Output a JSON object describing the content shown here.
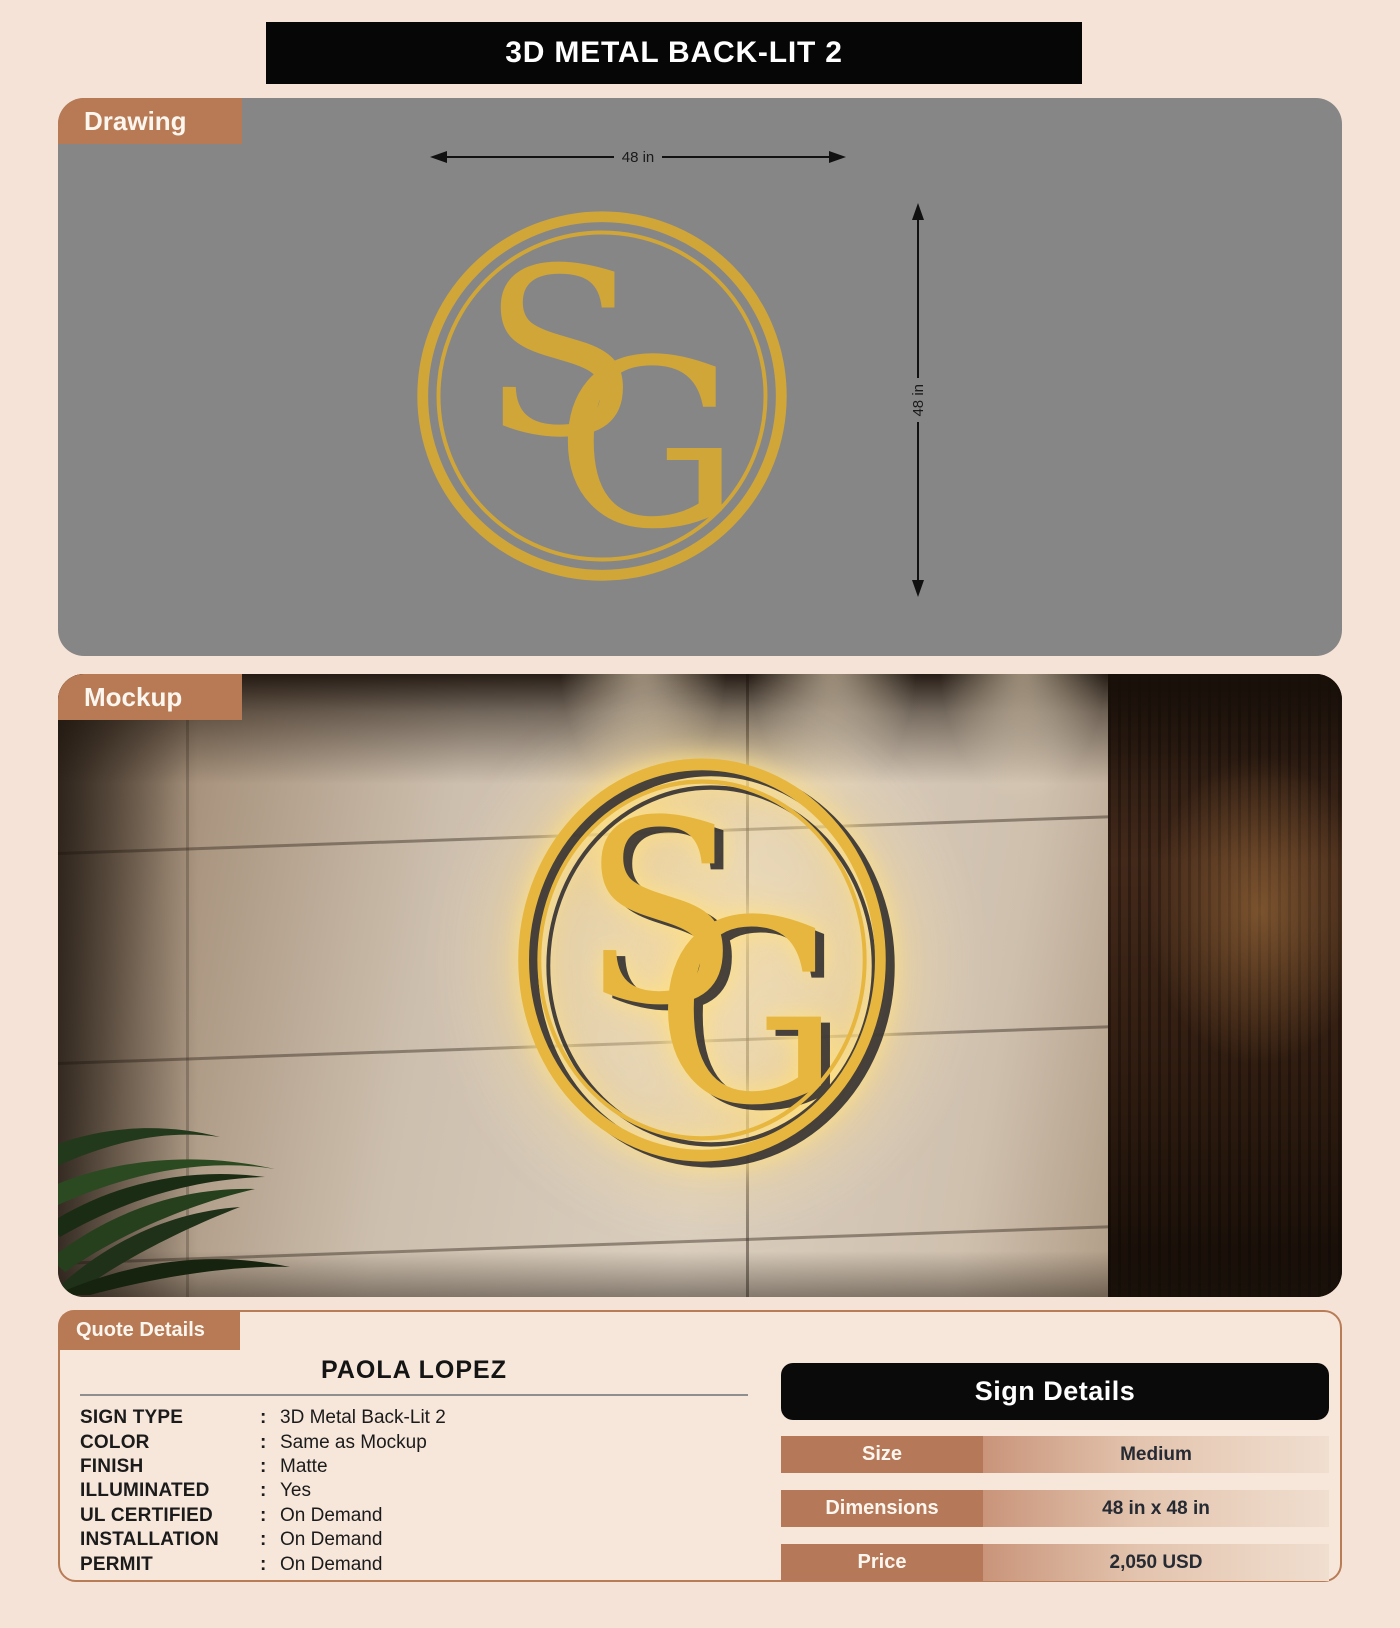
{
  "title": "3D METAL BACK-LIT 2",
  "logo": {
    "s": "S",
    "g": "G"
  },
  "drawing": {
    "label": "Drawing",
    "width_label": "48 in",
    "height_label": "48 in"
  },
  "mockup": {
    "label": "Mockup"
  },
  "quote": {
    "label": "Quote Details",
    "customer": "PAOLA LOPEZ",
    "separator": ":",
    "rows": [
      {
        "label": "SIGN TYPE",
        "value": "3D Metal Back-Lit 2"
      },
      {
        "label": "COLOR",
        "value": "Same as Mockup"
      },
      {
        "label": "FINISH",
        "value": "Matte"
      },
      {
        "label": "ILLUMINATED",
        "value": "Yes"
      },
      {
        "label": "UL CERTIFIED",
        "value": "On Demand"
      },
      {
        "label": "INSTALLATION",
        "value": "On Demand"
      },
      {
        "label": "PERMIT",
        "value": "On Demand"
      }
    ]
  },
  "sign_details": {
    "title": "Sign Details",
    "rows": [
      {
        "label": "Size",
        "value": "Medium"
      },
      {
        "label": "Dimensions",
        "value": "48 in x 48 in"
      },
      {
        "label": "Price",
        "value": "2,050 USD"
      }
    ]
  },
  "colors": {
    "background": "#f6e3d7",
    "accent_copper": "#b77a55",
    "gold": "#d0a639",
    "panel_gray": "#868686",
    "header_black": "#060606"
  }
}
